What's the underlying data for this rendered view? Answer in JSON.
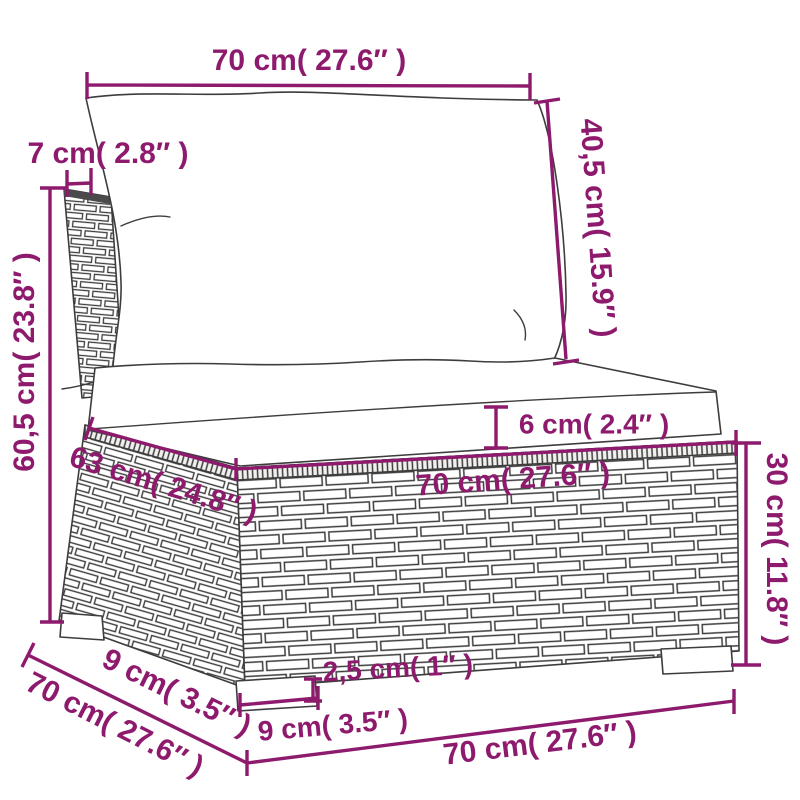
{
  "diagram": {
    "kind": "product-dimension-diagram",
    "subject": "poly-rattan garden middle sofa with seat and back cushions",
    "accent_color": "#8e1a6d",
    "drawing_line_color": "#3d3d3d",
    "background_color": "#ffffff",
    "units": "centimeters with inches in parentheses"
  },
  "labels": {
    "top_width": "70 cm( 27.6″ )",
    "back_thickness": "7 cm( 2.8″ )",
    "back_cushion_height": "40,5 cm( 15.9″ )",
    "overall_height": "60,5 cm( 23.8″ )",
    "seat_cushion_thickness": "6 cm( 2.4″ )",
    "seat_depth": "63 cm( 24.8″ )",
    "seat_width": "70 cm( 27.6″ )",
    "base_height": "30 cm( 11.8″ )",
    "leg_inset_depth": "9 cm( 3.5″ )",
    "overall_depth": "70 cm( 27.6″ )",
    "leg_width": "9 cm( 3.5″ )",
    "leg_height": "2,5 cm( 1″ )",
    "base_width": "70 cm( 27.6″ )"
  }
}
